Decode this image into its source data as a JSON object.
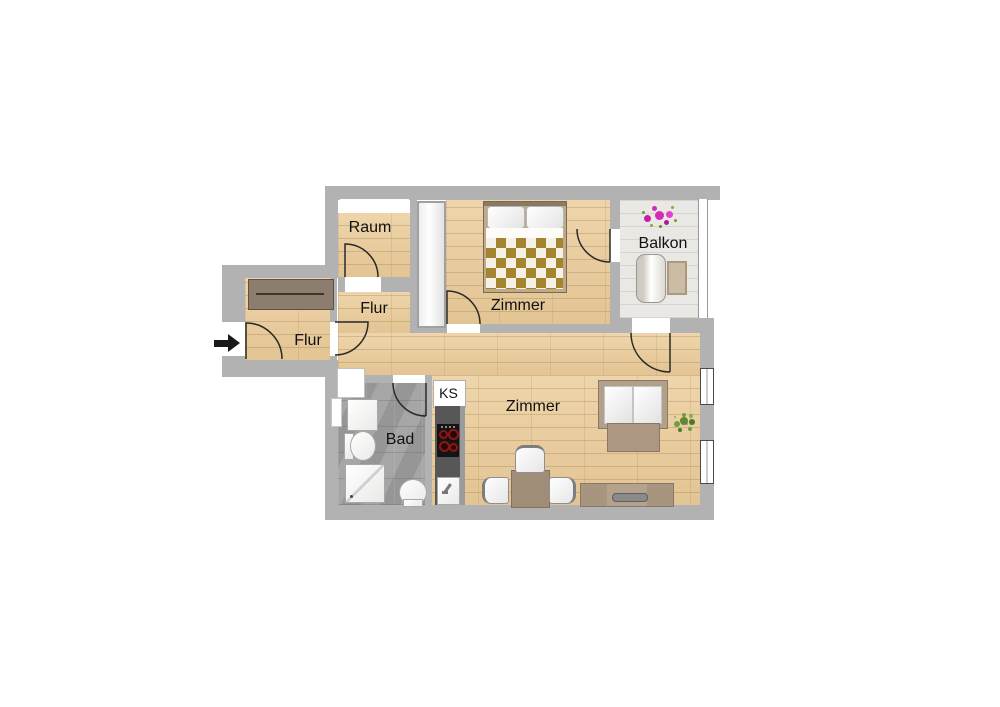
{
  "plan": {
    "title": "apartment floor plan",
    "labels": {
      "raum": "Raum",
      "flur_upper": "Flur",
      "flur_entry": "Flur",
      "bedroom": "Zimmer",
      "living_room": "Zimmer",
      "balcony": "Balkon",
      "bathroom": "Bad",
      "kitchenette": "KS"
    },
    "icons": {
      "entrance_arrow": "arrow-right",
      "balcony_flowers": "flower-cluster",
      "living_plant": "potted-plant"
    },
    "colors": {
      "wall": "#b2b2b2",
      "wood_floor": "#e9cfa4",
      "tile_floor": "#9e9e9e",
      "balcony_floor": "#eae8e4",
      "kitchen_counter": "#575757",
      "furniture_tan": "#b3a08b",
      "bed_blanket": "#a5842f",
      "flower_pink": "#d92cb8",
      "plant_green": "#6a9a3a",
      "door_stroke": "#2a2a2a"
    }
  }
}
